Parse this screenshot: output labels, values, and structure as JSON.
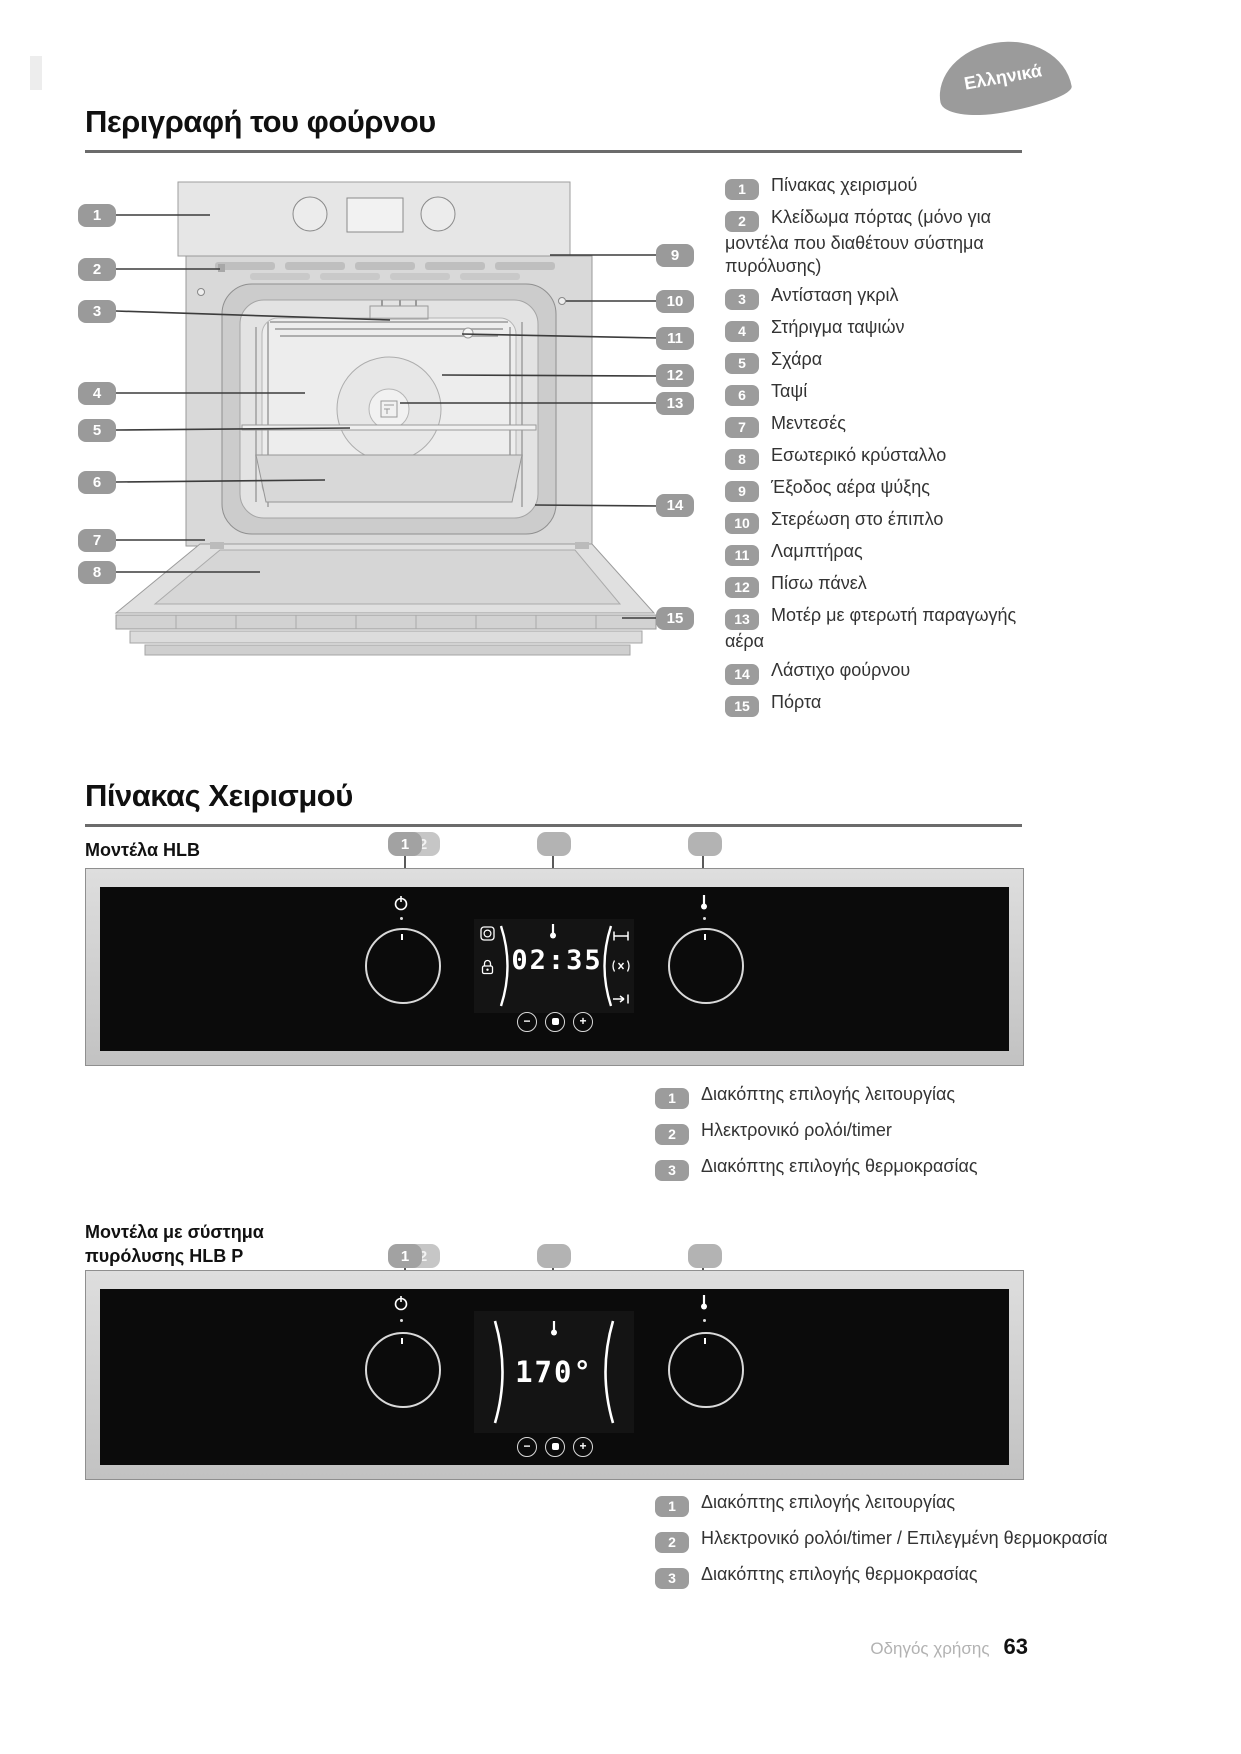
{
  "page": {
    "language_badge": "Ελληνικά",
    "footer_label": "Οδηγός χρήσης",
    "footer_page": "63"
  },
  "colors": {
    "badge_gray": "#9b9b9b",
    "panel_black": "#0b0b0b",
    "display_text": "#ffffff"
  },
  "oven_section": {
    "title": "Περιγραφή του φούρνου",
    "legend": [
      {
        "num": "1",
        "label": "Πίνακας χειρισμού"
      },
      {
        "num": "2",
        "label": "Κλείδωμα πόρτας (μόνο για μοντέλα που διαθέτουν σύστημα πυρόλυσης)"
      },
      {
        "num": "3",
        "label": "Αντίσταση γκριλ"
      },
      {
        "num": "4",
        "label": "Στήριγμα ταψιών"
      },
      {
        "num": "5",
        "label": "Σχάρα"
      },
      {
        "num": "6",
        "label": "Ταψί"
      },
      {
        "num": "7",
        "label": "Μεντεσές"
      },
      {
        "num": "8",
        "label": "Εσωτερικό κρύσταλλο"
      },
      {
        "num": "9",
        "label": "Έξοδος αέρα ψύξης"
      },
      {
        "num": "10",
        "label": "Στερέωση στο έπιπλο"
      },
      {
        "num": "11",
        "label": "Λαμπτήρας"
      },
      {
        "num": "12",
        "label": "Πίσω πάνελ"
      },
      {
        "num": "13",
        "label": "Μοτέρ με φτερωτή παραγωγής αέρα"
      },
      {
        "num": "14",
        "label": "Λάστιχο φούρνου"
      },
      {
        "num": "15",
        "label": "Πόρτα"
      }
    ]
  },
  "control_section": {
    "title": "Πίνακας Χειρισμού",
    "models": [
      {
        "label": "Μοντέλα HLB",
        "display_value": "02:35",
        "callout_left_primary": "1",
        "callout_left_secondary": "2",
        "left_knob_icon": "power-icon",
        "right_knob_icon": "thermometer-icon",
        "display_icons": [
          "auto-program-icon",
          "lock-icon",
          "thermometer-icon",
          "duration-icon",
          "sound-icon",
          "end-time-icon"
        ],
        "icons": {
          "minus": "−",
          "plus": "+"
        },
        "legend": [
          {
            "num": "1",
            "label": "Διακόπτης επιλογής λειτουργίας"
          },
          {
            "num": "2",
            "label": "Ηλεκτρονικό ρολόι/timer"
          },
          {
            "num": "3",
            "label": "Διακόπτης επιλογής θερμοκρασίας"
          }
        ]
      },
      {
        "label": "Μοντέλα με σύστημα πυρόλυσης HLB P",
        "display_value": "170°",
        "callout_left_primary": "1",
        "callout_left_secondary": "2",
        "left_knob_icon": "power-icon",
        "right_knob_icon": "thermometer-icon",
        "display_icons": [
          "thermometer-icon"
        ],
        "icons": {
          "minus": "−",
          "plus": "+"
        },
        "legend": [
          {
            "num": "1",
            "label": "Διακόπτης επιλογής λειτουργίας"
          },
          {
            "num": "2",
            "label": "Ηλεκτρονικό ρολόι/timer / Επιλεγμένη θερμοκρασία"
          },
          {
            "num": "3",
            "label": "Διακόπτης επιλογής θερμοκρασίας"
          }
        ]
      }
    ]
  }
}
